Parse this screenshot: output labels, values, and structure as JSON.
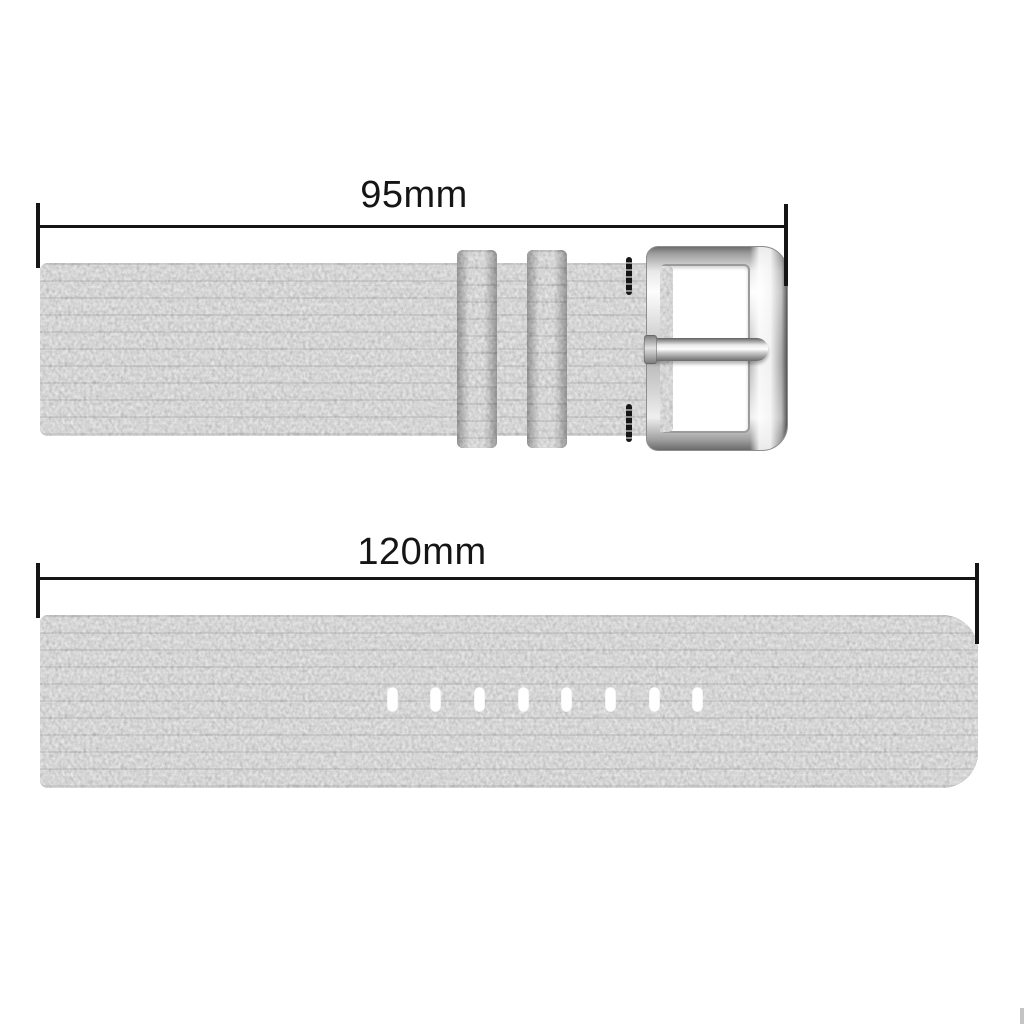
{
  "page": {
    "background": "#ffffff"
  },
  "dimensions": {
    "top": {
      "label": "95mm"
    },
    "bottom": {
      "label": "120mm"
    }
  },
  "top_strap": {
    "keeper_count": 2,
    "stitch_rows": 2,
    "has_buckle": true
  },
  "bottom_strap": {
    "hole_count": 8
  },
  "colors": {
    "dimension_line": "#151515",
    "fabric_base": "#a9a9a9",
    "metal_light": "#fdfdfd",
    "metal_dark": "#6b6b6b",
    "hole": "#ffffff",
    "background": "#ffffff"
  }
}
